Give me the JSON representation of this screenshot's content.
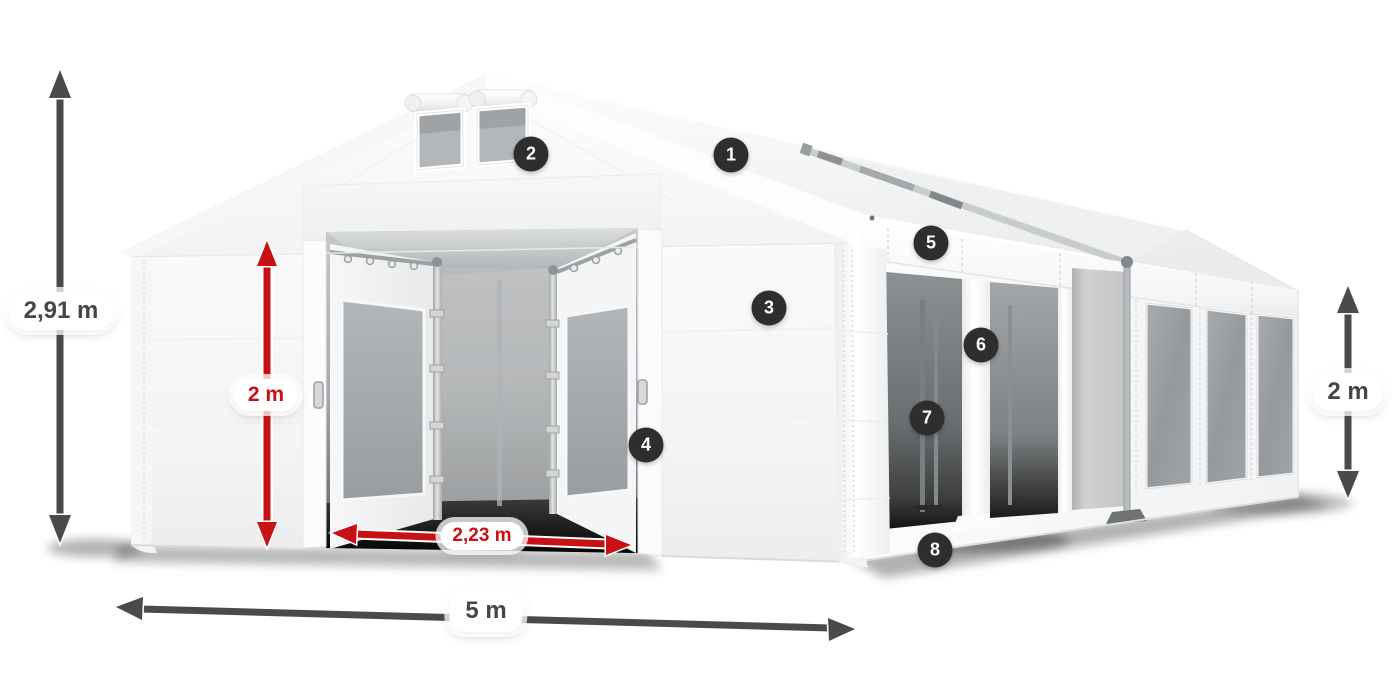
{
  "diagram": {
    "subject": "party-tent-dimension-diagram",
    "badges": [
      {
        "label": "1",
        "part": "roof-cover"
      },
      {
        "label": "2",
        "part": "gable-vent-window"
      },
      {
        "label": "3",
        "part": "front-wall-panel"
      },
      {
        "label": "4",
        "part": "entrance-door-edge"
      },
      {
        "label": "5",
        "part": "side-valance"
      },
      {
        "label": "6",
        "part": "side-opening-panel"
      },
      {
        "label": "7",
        "part": "inner-frame-pole"
      },
      {
        "label": "8",
        "part": "side-wall-base"
      }
    ],
    "dimensions": {
      "total_height": "2,91 m",
      "door_height": "2 m",
      "door_width": "2,23 m",
      "total_width": "5 m",
      "side_height": "2 m"
    },
    "colors": {
      "badge_bg": "#2e2e2e",
      "badge_text": "#ffffff",
      "dimension_arrow": "#4a4a4b",
      "dimension_text": "#464648",
      "highlight_red": "#c81114",
      "pill_bg": "#ffffff",
      "tent_white": "#f7f8f9"
    }
  }
}
